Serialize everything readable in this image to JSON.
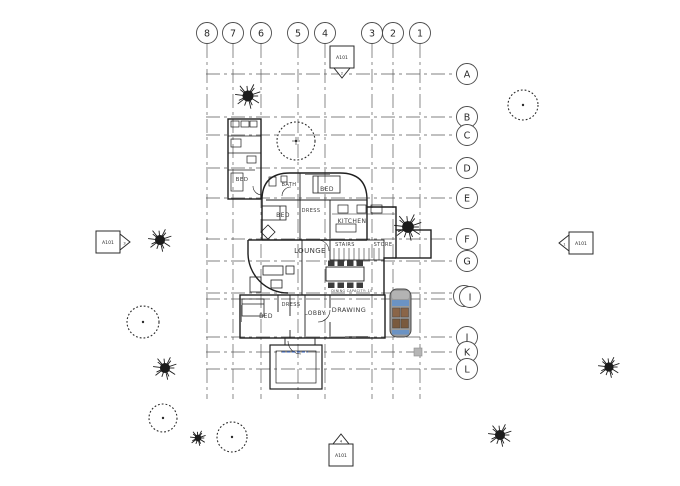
{
  "drawing": {
    "type": "architectural-floor-plan",
    "colors": {
      "line": "#1f1f1f",
      "grid": "#5a5a5a",
      "selected_blue": "#2f5fc0",
      "override_orange": "#c2571b",
      "car_body": "#9a9a9a",
      "car_glass": "#6b93c4",
      "car_seat": "#8a6548",
      "pad_gray": "#b5b5b5"
    }
  },
  "grid": {
    "bubble_radius": 10.5,
    "column_bubble_y": 33,
    "column_line_top": 44,
    "column_line_bottom": 399,
    "row_bubble_x": 467,
    "row_line_left": 206,
    "columns": [
      {
        "label": "8",
        "x": 207
      },
      {
        "label": "7",
        "x": 233
      },
      {
        "label": "6",
        "x": 261
      },
      {
        "label": "5",
        "x": 298
      },
      {
        "label": "4",
        "x": 325
      },
      {
        "label": "3",
        "x": 372
      },
      {
        "label": "2",
        "x": 393
      },
      {
        "label": "1",
        "x": 420
      }
    ],
    "rows": [
      {
        "label": "A",
        "y": 74
      },
      {
        "label": "B",
        "y": 117
      },
      {
        "label": "C",
        "y": 135
      },
      {
        "label": "D",
        "y": 168
      },
      {
        "label": "E",
        "y": 198
      },
      {
        "label": "F",
        "y": 239
      },
      {
        "label": "G",
        "y": 261
      },
      {
        "label": "H",
        "y": 293,
        "bubble_x": 464,
        "bubble_y": 296,
        "label_color": "#c2571b"
      },
      {
        "label": "I",
        "y": 299,
        "bubble_x": 470,
        "bubble_y": 297,
        "label_color": "#2f5fc0"
      },
      {
        "label": "J",
        "y": 337
      },
      {
        "label": "K",
        "y": 352
      },
      {
        "label": "L",
        "y": 369
      }
    ]
  },
  "section_markers": [
    {
      "sheet": "A101",
      "number": "2",
      "cx": 342,
      "cy": 57,
      "dir": "down"
    },
    {
      "sheet": "A101",
      "number": "3",
      "cx": 108,
      "cy": 242,
      "dir": "right"
    },
    {
      "sheet": "A101",
      "number": "1",
      "cx": 581,
      "cy": 243,
      "dir": "left"
    },
    {
      "sheet": "A101",
      "number": "4",
      "cx": 341,
      "cy": 455,
      "dir": "up"
    }
  ],
  "rooms": [
    {
      "label": "BED",
      "x": 242,
      "y": 181,
      "size": 5.5
    },
    {
      "label": "BATH",
      "x": 289,
      "y": 186,
      "size": 5
    },
    {
      "label": "BED",
      "x": 327,
      "y": 191,
      "size": 6
    },
    {
      "label": "BED",
      "x": 283,
      "y": 217,
      "size": 6
    },
    {
      "label": "DRESS",
      "x": 311,
      "y": 212,
      "size": 5
    },
    {
      "label": "KITCHEN",
      "x": 352,
      "y": 223,
      "size": 6
    },
    {
      "label": "STAIRS",
      "x": 345,
      "y": 246,
      "size": 5
    },
    {
      "label": "STORE",
      "x": 383,
      "y": 246,
      "size": 5
    },
    {
      "label": "LOUNGE",
      "x": 310,
      "y": 253,
      "size": 7
    },
    {
      "label": "BED",
      "x": 266,
      "y": 318,
      "size": 6
    },
    {
      "label": "DRESS",
      "x": 291,
      "y": 306,
      "size": 5
    },
    {
      "label": "LOBBY",
      "x": 315,
      "y": 315,
      "size": 6
    },
    {
      "label": "DRAWING",
      "x": 349,
      "y": 312,
      "size": 6.5
    }
  ],
  "annotations": [
    {
      "text": "DINING CAPACITY: 10",
      "x": 352,
      "y": 292,
      "size": 3.2
    }
  ],
  "trees": [
    {
      "type": "conifer",
      "x": 248,
      "y": 96,
      "r": 13
    },
    {
      "type": "deciduous",
      "x": 523,
      "y": 105,
      "r": 15
    },
    {
      "type": "deciduous",
      "x": 296,
      "y": 141,
      "r": 19,
      "cross": true
    },
    {
      "type": "conifer",
      "x": 160,
      "y": 240,
      "r": 12
    },
    {
      "type": "conifer",
      "x": 408,
      "y": 227,
      "r": 14
    },
    {
      "type": "deciduous",
      "x": 143,
      "y": 322,
      "r": 16
    },
    {
      "type": "conifer",
      "x": 165,
      "y": 368,
      "r": 12
    },
    {
      "type": "conifer",
      "x": 609,
      "y": 367,
      "r": 11
    },
    {
      "type": "deciduous",
      "x": 163,
      "y": 418,
      "r": 14
    },
    {
      "type": "conifer",
      "x": 198,
      "y": 438,
      "r": 8
    },
    {
      "type": "deciduous",
      "x": 232,
      "y": 437,
      "r": 15
    },
    {
      "type": "conifer",
      "x": 500,
      "y": 435,
      "r": 12
    }
  ],
  "car": {
    "x": 390,
    "y": 289,
    "width": 21,
    "height": 48
  },
  "pad": {
    "x": 414,
    "y": 348,
    "size": 8
  }
}
